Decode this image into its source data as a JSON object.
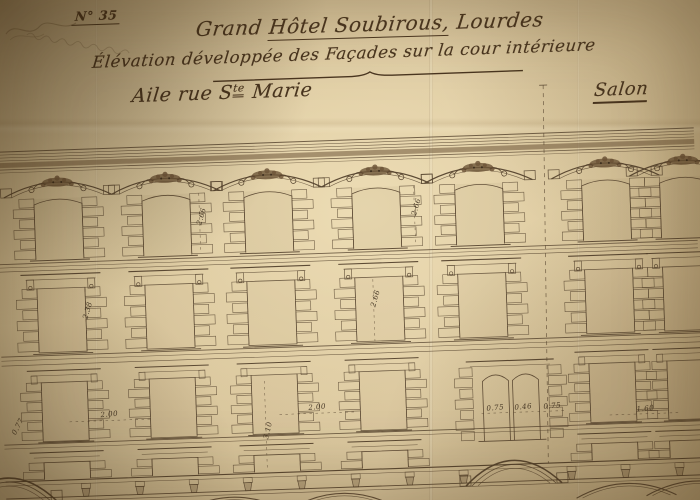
{
  "photo": {
    "subject": "hand-drawn architectural elevation sheet, aged paper, photographed at an angle"
  },
  "titleblock": {
    "sheet_number": "N° 35",
    "title_pre": "Grand",
    "title_underlined": "Hôtel Soubirous,",
    "title_post": "Lourdes",
    "subtitle": "Élévation développée des Façades sur la cour intérieure",
    "wing_label_pre": "Aile rue S",
    "wing_label_sup": "te",
    "wing_label_post": "Marie",
    "salon_label": "Salon"
  },
  "drawing": {
    "type": "facade-elevation",
    "visible_storeys": 4,
    "bays_upper": [
      62,
      170,
      272,
      380,
      483,
      610,
      688
    ],
    "bays_lower": [
      62,
      170,
      272,
      380,
      610,
      688
    ],
    "twin_window_x": 508,
    "arch_centers": [
      2,
      508
    ],
    "separator_x": 547,
    "dimensions": [
      {
        "text": "2.66",
        "x": 207,
        "y": 84,
        "rot": -72,
        "line": [
          203,
          60,
          203,
          120
        ]
      },
      {
        "text": "2.66",
        "x": 422,
        "y": 82,
        "rot": -72,
        "line": [
          418,
          60,
          418,
          120
        ]
      },
      {
        "text": "2.38",
        "x": 90,
        "y": 174,
        "rot": -72,
        "line": [
          86,
          152,
          86,
          214
        ]
      },
      {
        "text": "2.66",
        "x": 378,
        "y": 172,
        "rot": -72,
        "line": [
          374,
          152,
          374,
          214
        ]
      },
      {
        "text": "3.10",
        "x": 266,
        "y": 300,
        "rot": -75,
        "line": [
          262,
          250,
          262,
          340
        ]
      },
      {
        "text": "2.00",
        "x": 106,
        "y": 280,
        "rot": -3,
        "line": [
          66,
          284,
          148,
          284
        ]
      },
      {
        "text": "2.00",
        "x": 314,
        "y": 280,
        "rot": -3,
        "line": [
          276,
          284,
          354,
          284
        ]
      },
      {
        "text": "0.75",
        "x": 492,
        "y": 287,
        "rot": -3,
        "line": [
          478,
          290,
          506,
          290
        ]
      },
      {
        "text": "0.46",
        "x": 520,
        "y": 287,
        "rot": -3,
        "line": [
          510,
          290,
          530,
          290
        ]
      },
      {
        "text": "0.75",
        "x": 549,
        "y": 287,
        "rot": -3,
        "line": [
          534,
          290,
          564,
          290
        ]
      },
      {
        "text": "1.60",
        "x": 642,
        "y": 293,
        "rot": -3,
        "line": [
          606,
          296,
          678,
          296
        ]
      },
      {
        "text": "0.77",
        "x": 16,
        "y": 288,
        "rot": -60,
        "line": null
      }
    ]
  },
  "colors": {
    "paper": "#d8c59b",
    "ink": "#55432e",
    "ink_dark": "#3c2e1e",
    "ornament": "#6e5639",
    "handwriting": "#4a3620"
  }
}
